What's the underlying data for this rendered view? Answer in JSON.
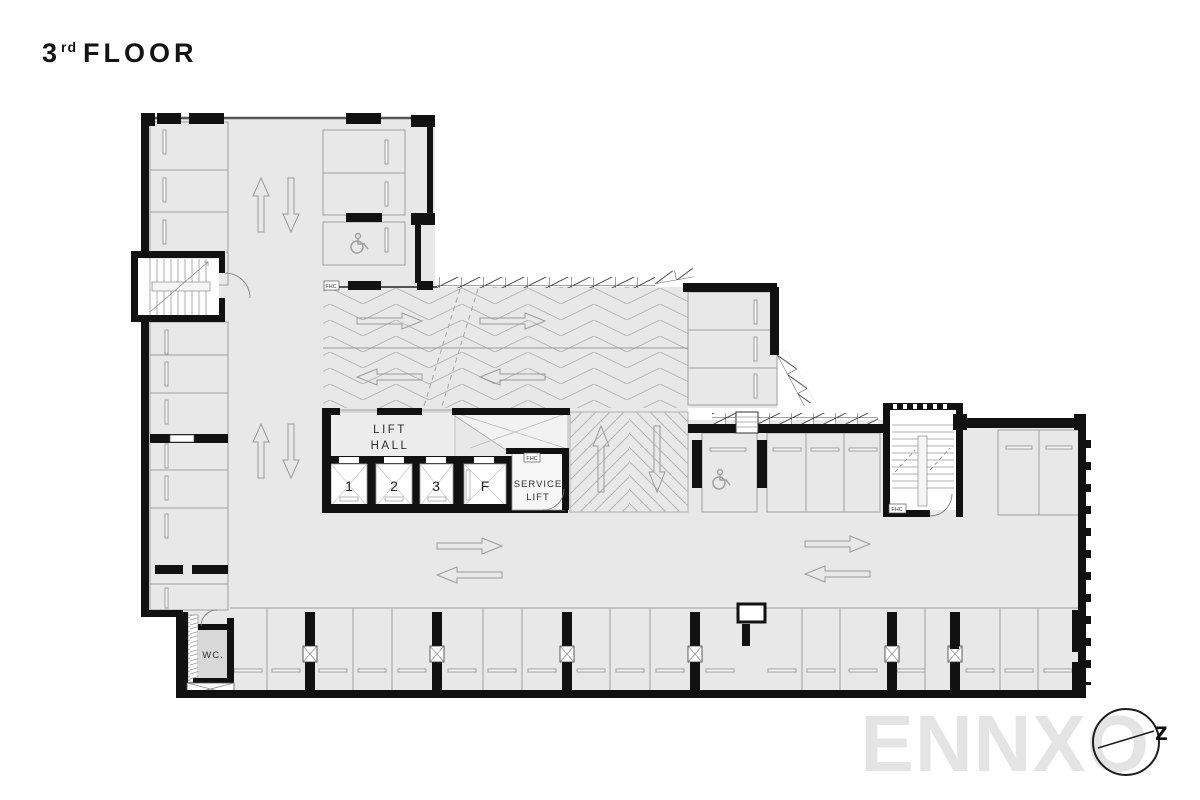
{
  "title": {
    "number": "3",
    "ordinal": "rd",
    "word": "FLOOR"
  },
  "watermark": {
    "brand": "ENNXO",
    "north_glyph": "z"
  },
  "plan": {
    "lift_hall": {
      "line1": "LIFT",
      "line2": "HALL"
    },
    "lifts": [
      {
        "label": "1"
      },
      {
        "label": "2"
      },
      {
        "label": "3"
      },
      {
        "label": "F"
      }
    ],
    "service_lift": {
      "line1": "SERVICE",
      "line2": "LIFT"
    },
    "rooms": {
      "wc": "WC."
    },
    "annotations": {
      "fhc": "FHC"
    }
  },
  "colors": {
    "wall": "#111111",
    "floor": "#e8e8e8",
    "line": "#9a9a9a",
    "watermark": "#e4e4e4"
  }
}
